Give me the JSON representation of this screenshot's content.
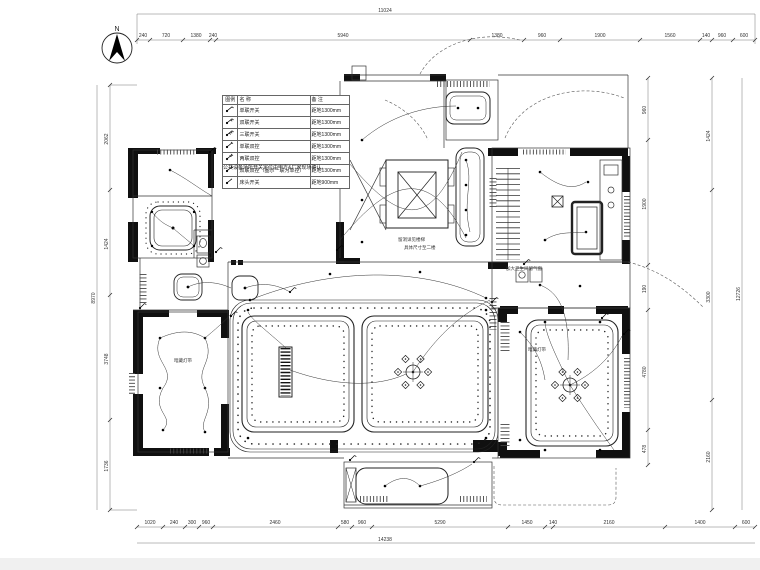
{
  "drawing": {
    "north_label": "N"
  },
  "legend": {
    "col_symbol": "图例",
    "col_name": "名 称",
    "col_remark": "备 注",
    "rows": [
      {
        "name": "单联开关",
        "remark": "距地1300mm"
      },
      {
        "name": "双联开关",
        "remark": "距地1300mm"
      },
      {
        "name": "三联开关",
        "remark": "距地1300mm"
      },
      {
        "name": "单联双控",
        "remark": "距地1300mm"
      },
      {
        "name": "两联双控",
        "remark": "距地1300mm"
      },
      {
        "name": "双联双控（图示一联为单控）",
        "remark": "距地1300mm"
      },
      {
        "name": "床头开关",
        "remark": "距地900mm"
      }
    ],
    "note": "公共设备场所开关定位由甲方&厂家现场确认。"
  },
  "annotations": {
    "elevator_note_line1": "留洞详见楼梯",
    "elevator_note_line2": "具体尺寸至二楼",
    "vent_note": "加大卫生间留气窗",
    "cove_note_left": "暗藏灯带",
    "cove_note_right": "暗藏灯带"
  },
  "dims": {
    "top_total": "11024",
    "bottom_total": "14238",
    "left_total": "8970",
    "right_total": "12726",
    "top_chain": [
      "240",
      "720",
      "1380",
      "240",
      "5940",
      "1380",
      "960",
      "1900",
      "1560",
      "140",
      "960",
      "600"
    ],
    "bottom_chain": [
      "1020",
      "240",
      "300",
      "960",
      "2460",
      "580",
      "960",
      "5290",
      "1450",
      "140",
      "2160",
      "1400",
      "600"
    ],
    "left_chain": [
      "2062",
      "1424",
      "3748",
      "1736"
    ],
    "right_inner_chain": [
      "960",
      "1900",
      "190",
      "4780",
      "478"
    ],
    "right_outer_chain": [
      "1424",
      "3300",
      "2160"
    ]
  }
}
